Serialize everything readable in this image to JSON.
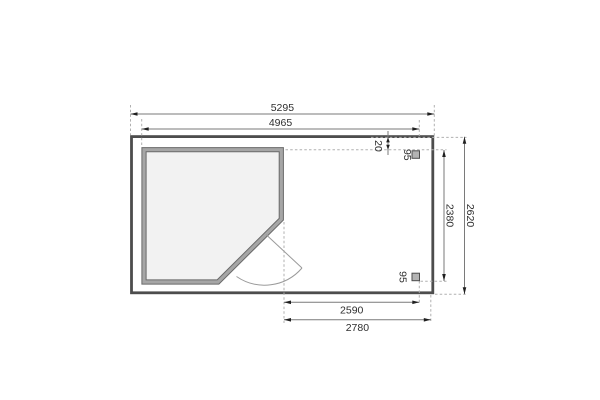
{
  "plan": {
    "type": "floor-plan",
    "dims": {
      "top_outer": "5295",
      "top_inner": "4965",
      "right_outer": "2620",
      "right_inner": "2380",
      "bottom_inner": "2590",
      "bottom_outer": "2780",
      "edge_gap": "20",
      "post_top": "95",
      "post_bottom": "95"
    },
    "colors": {
      "platform_outline": "#4d4d4d",
      "wall_edge": "#6a6a6a",
      "wall_core": "#a6a6a6",
      "floor_fill": "#f2f2f2",
      "post_fill": "#b3b3b3",
      "dim_line": "#7a7a7a",
      "dash_line": "#b0b0b0",
      "text": "#2e2e2e"
    }
  }
}
